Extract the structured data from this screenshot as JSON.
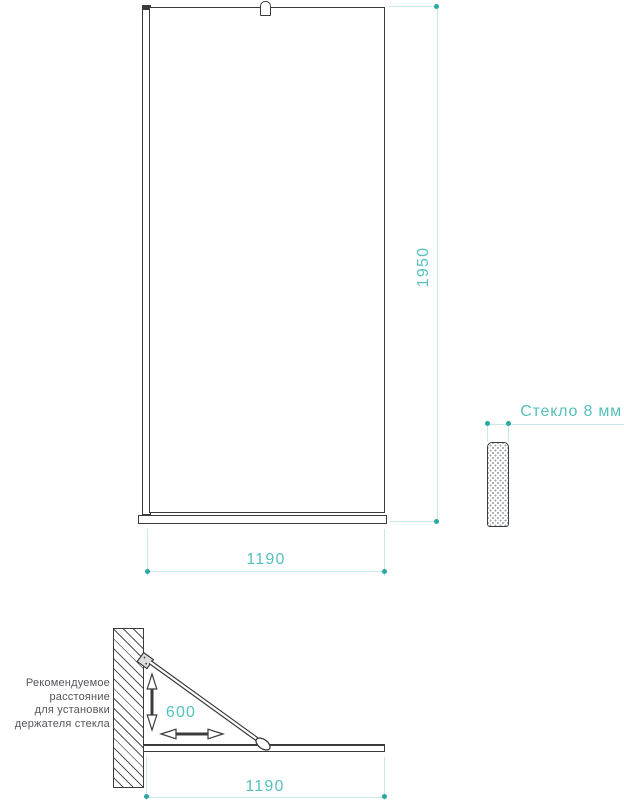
{
  "front_view": {
    "height_label": "1950",
    "width_label": "1190"
  },
  "thickness_view": {
    "glass_label": "Стекло 8 мм"
  },
  "plan_view": {
    "holder_distance_label": "600",
    "width_label": "1190",
    "annotation_lines": [
      "Рекомендуемое",
      "расстояние",
      "для установки",
      "держателя стекла"
    ]
  },
  "colors": {
    "accent_teal": "#56c0bb",
    "dot_teal": "#2aa8a2",
    "light_dimension_line": "#c9e9e7",
    "outline_dark": "#3b3b3d",
    "annotation_gray": "#55565a"
  }
}
